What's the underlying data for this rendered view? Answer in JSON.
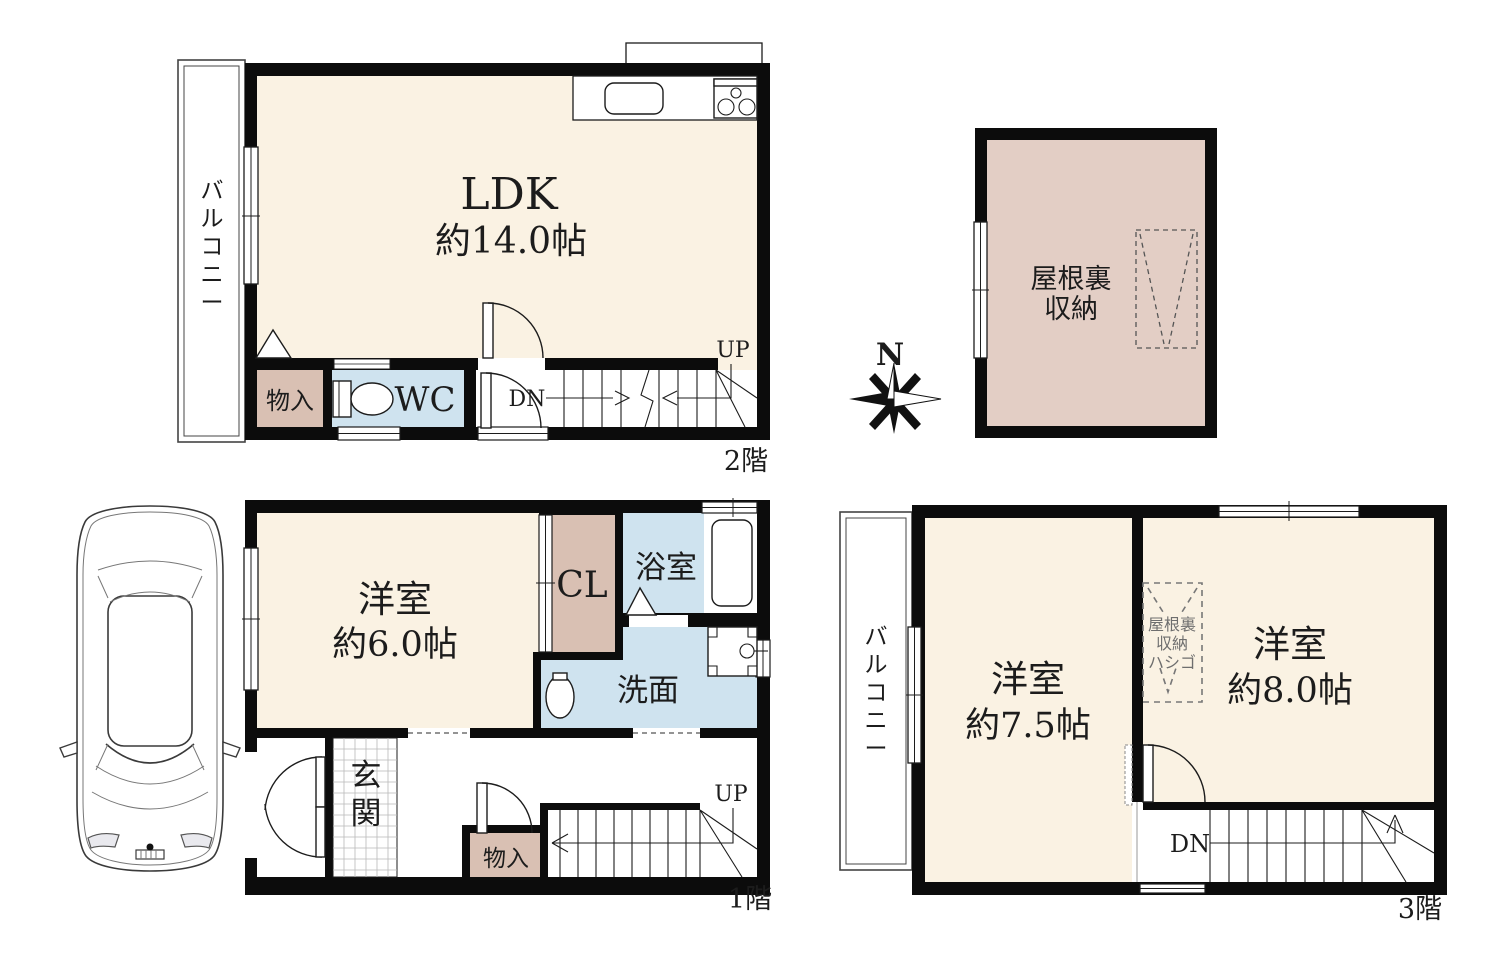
{
  "colors": {
    "room_cream": "#FAF2E3",
    "storage_pink": "#D9C0B3",
    "attic_pink": "#E3CEC5",
    "wet_blue": "#CFE3EF",
    "wall_black": "#0C0C0C"
  },
  "f2": {
    "floor_label": "2階",
    "balcony": "バルコニー",
    "room": "LDK",
    "room_size": "約14.0帖",
    "storage": "物入",
    "wc": "WC",
    "dn": "DN",
    "up": "UP"
  },
  "attic": {
    "label_line1": "屋根裏",
    "label_line2": "収納",
    "north": "N"
  },
  "f1": {
    "floor_label": "1階",
    "room": "洋室",
    "room_size": "約6.0帖",
    "closet": "CL",
    "bath": "浴室",
    "washroom": "洗面",
    "entrance": "玄関",
    "storage": "物入",
    "up": "UP"
  },
  "f3": {
    "floor_label": "3階",
    "balcony": "バルコニー",
    "room_left": "洋室",
    "room_left_size": "約7.5帖",
    "room_right": "洋室",
    "room_right_size": "約8.0帖",
    "ladder_line1": "屋根裏",
    "ladder_line2": "収納",
    "ladder_line3": "ハシゴ",
    "dn": "DN"
  }
}
